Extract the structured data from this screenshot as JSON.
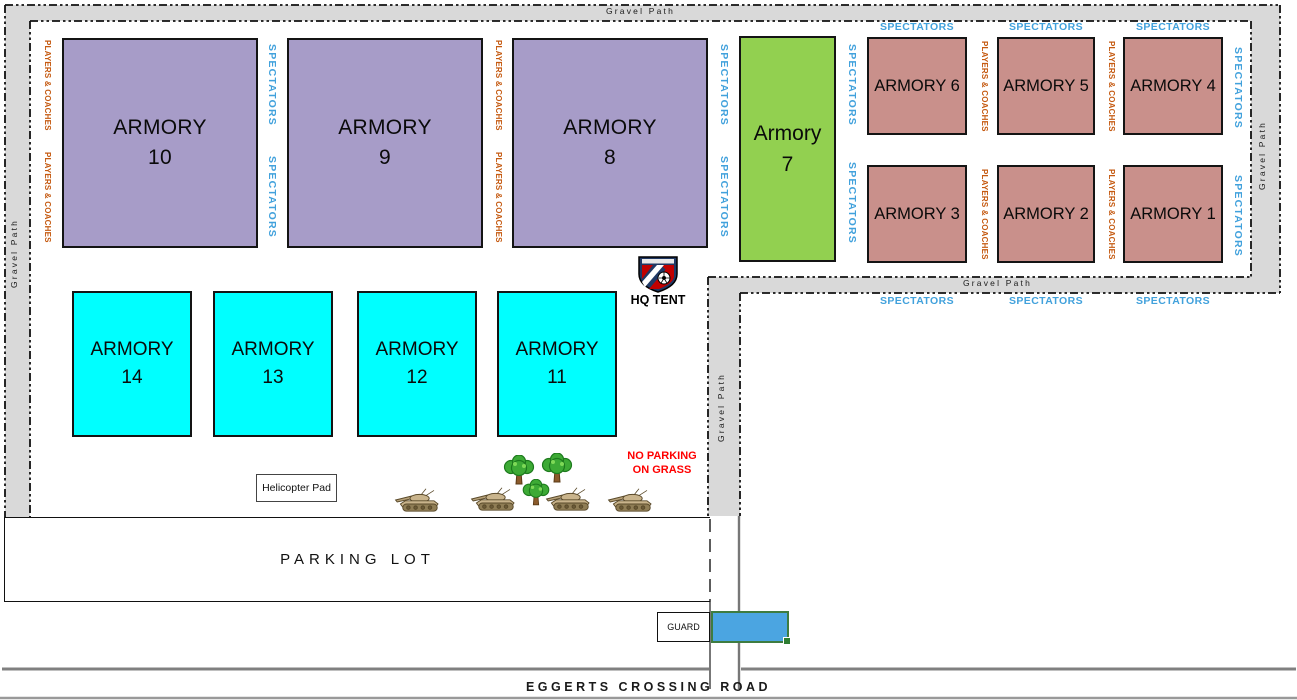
{
  "map": {
    "gravel_path_label": "Gravel Path",
    "spectators_label": "SPECTATORS",
    "players_coaches_label": "PLAYERS & COACHES",
    "hq_tent_label": "HQ TENT",
    "helicopter_pad_label": "Helicopter Pad",
    "no_parking_line1": "NO PARKING",
    "no_parking_line2": "ON GRASS",
    "parking_lot_label": "PARKING LOT",
    "guard_label": "GUARD",
    "road_label": "EGGERTS CROSSING ROAD"
  },
  "fields": {
    "a10": {
      "line1": "ARMORY",
      "line2": "10"
    },
    "a9": {
      "line1": "ARMORY",
      "line2": "9"
    },
    "a8": {
      "line1": "ARMORY",
      "line2": "8"
    },
    "a7": {
      "line1": "Armory",
      "line2": "7"
    },
    "a6": {
      "label": "ARMORY 6"
    },
    "a5": {
      "label": "ARMORY 5"
    },
    "a4": {
      "label": "ARMORY 4"
    },
    "a3": {
      "label": "ARMORY 3"
    },
    "a2": {
      "label": "ARMORY 2"
    },
    "a1": {
      "label": "ARMORY 1"
    },
    "a14": {
      "line1": "ARMORY",
      "line2": "14"
    },
    "a13": {
      "line1": "ARMORY",
      "line2": "13"
    },
    "a12": {
      "line1": "ARMORY",
      "line2": "12"
    },
    "a11": {
      "line1": "ARMORY",
      "line2": "11"
    }
  },
  "icons": {
    "hq_logo": "soccer-club-shield",
    "tree": "tree-icon",
    "tank": "tank-icon",
    "gate_handle": "selection-handle"
  },
  "colors": {
    "field_purple": "#A79CC8",
    "field_green": "#92D050",
    "field_salmon": "#C9908B",
    "field_cyan": "#00FFFF",
    "gravel_gray": "#D9D9D9",
    "spectators_blue": "#41A1DC",
    "players_coaches_orange": "#C55A11",
    "warning_red": "#FF0000",
    "gate_blue": "#4BA5E1",
    "selection_green": "#3E7C40"
  }
}
